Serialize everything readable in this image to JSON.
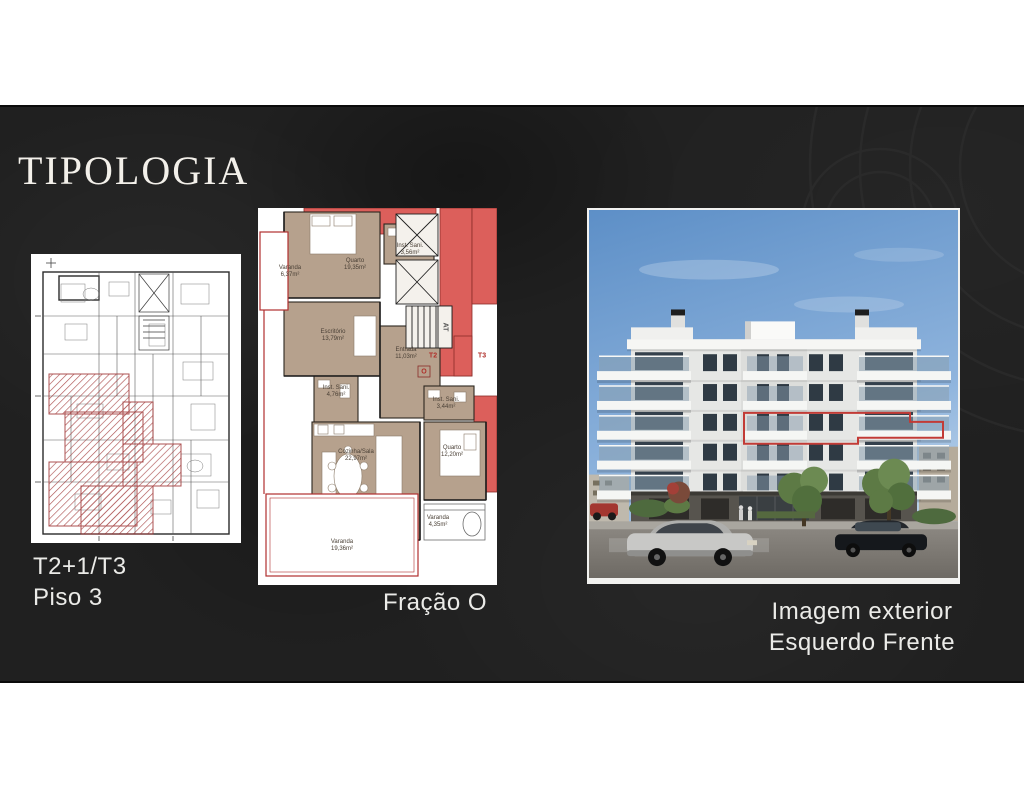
{
  "slide": {
    "title": "TIPOLOGIA",
    "left_plan": {
      "caption_line1": "T2+1/T3",
      "caption_line2": "Piso 3"
    },
    "middle_plan": {
      "caption": "Fração O",
      "rooms": [
        {
          "name": "Varanda",
          "area": "6,37m²"
        },
        {
          "name": "Quarto",
          "area": "19,35m²"
        },
        {
          "name": "Inst. Sani.",
          "area": "3,56m²"
        },
        {
          "name": "Escritório",
          "area": "13,79m²"
        },
        {
          "name": "Entrada",
          "area": "11,03m²"
        },
        {
          "name": "Inst. Sani.",
          "area": "4,76m²"
        },
        {
          "name": "Inst. Sani.",
          "area": "3,44m²"
        },
        {
          "name": "Cozinha/Sala",
          "area": "22,97m²"
        },
        {
          "name": "Quarto",
          "area": "12,20m²"
        },
        {
          "name": "Varanda",
          "area": "4,35m²"
        },
        {
          "name": "Varanda",
          "area": "19,36m²"
        }
      ],
      "markers": {
        "m1": "T2",
        "m2": "T3",
        "m3": "O",
        "m4": "AT"
      }
    },
    "exterior": {
      "caption_line1": "Imagem exterior",
      "caption_line2": "Esquerdo Frente"
    },
    "colors": {
      "slide_background": "#202020",
      "highlight_red": "#c23b36",
      "plan_tan": "#b6a18d",
      "plan_red": "#dc5f5b",
      "sky_blue": "#6d99cd"
    }
  }
}
